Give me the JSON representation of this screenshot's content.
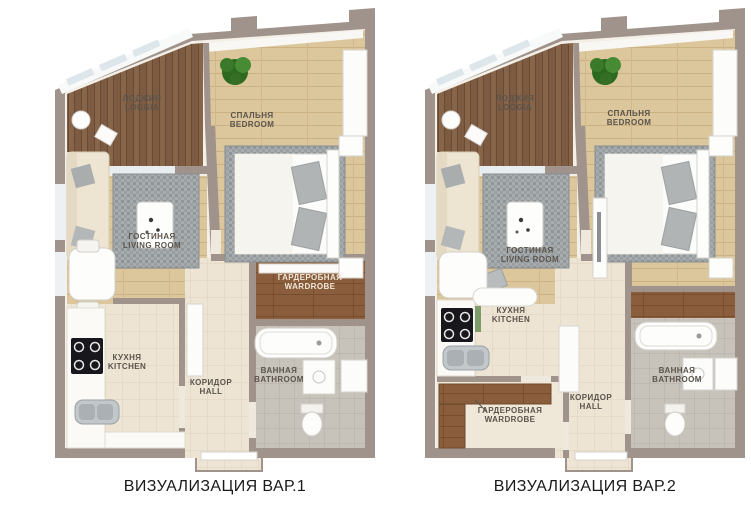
{
  "rooms": {
    "loggia": {
      "ru": "ЛОДЖИЯ",
      "en": "LOGGIA"
    },
    "bedroom": {
      "ru": "СПАЛЬНЯ",
      "en": "BEDROOM"
    },
    "living_room": {
      "ru": "ГОСТИНАЯ",
      "en": "LIVING ROOM"
    },
    "wardrobe": {
      "ru": "ГАРДЕРОБНАЯ",
      "en": "WARDROBE"
    },
    "kitchen": {
      "ru": "КУХНЯ",
      "en": "KITCHEN"
    },
    "hall": {
      "ru": "КОРИДОР",
      "en": "HALL"
    },
    "bathroom": {
      "ru": "ВАННАЯ",
      "en": "BATHROOM"
    }
  },
  "captions": {
    "variant1": "ВИЗУАЛИЗАЦИЯ ВАР.1",
    "variant2": "ВИЗУАЛИЗАЦИЯ ВАР.2"
  },
  "colors": {
    "wall": "#a0938b",
    "floor_wood_light": "#dcc69c",
    "floor_wood_loggia": "#7d5b42",
    "floor_wood_wardrobe": "#8a5e3d",
    "floor_tile_cream": "#ede4d3",
    "floor_tile_gray": "#c7c2ba",
    "rug_gray": "#a7acae",
    "plant_green": "#2d6a20",
    "label_text": "#5b544c",
    "caption_text": "#1a1a1a"
  }
}
